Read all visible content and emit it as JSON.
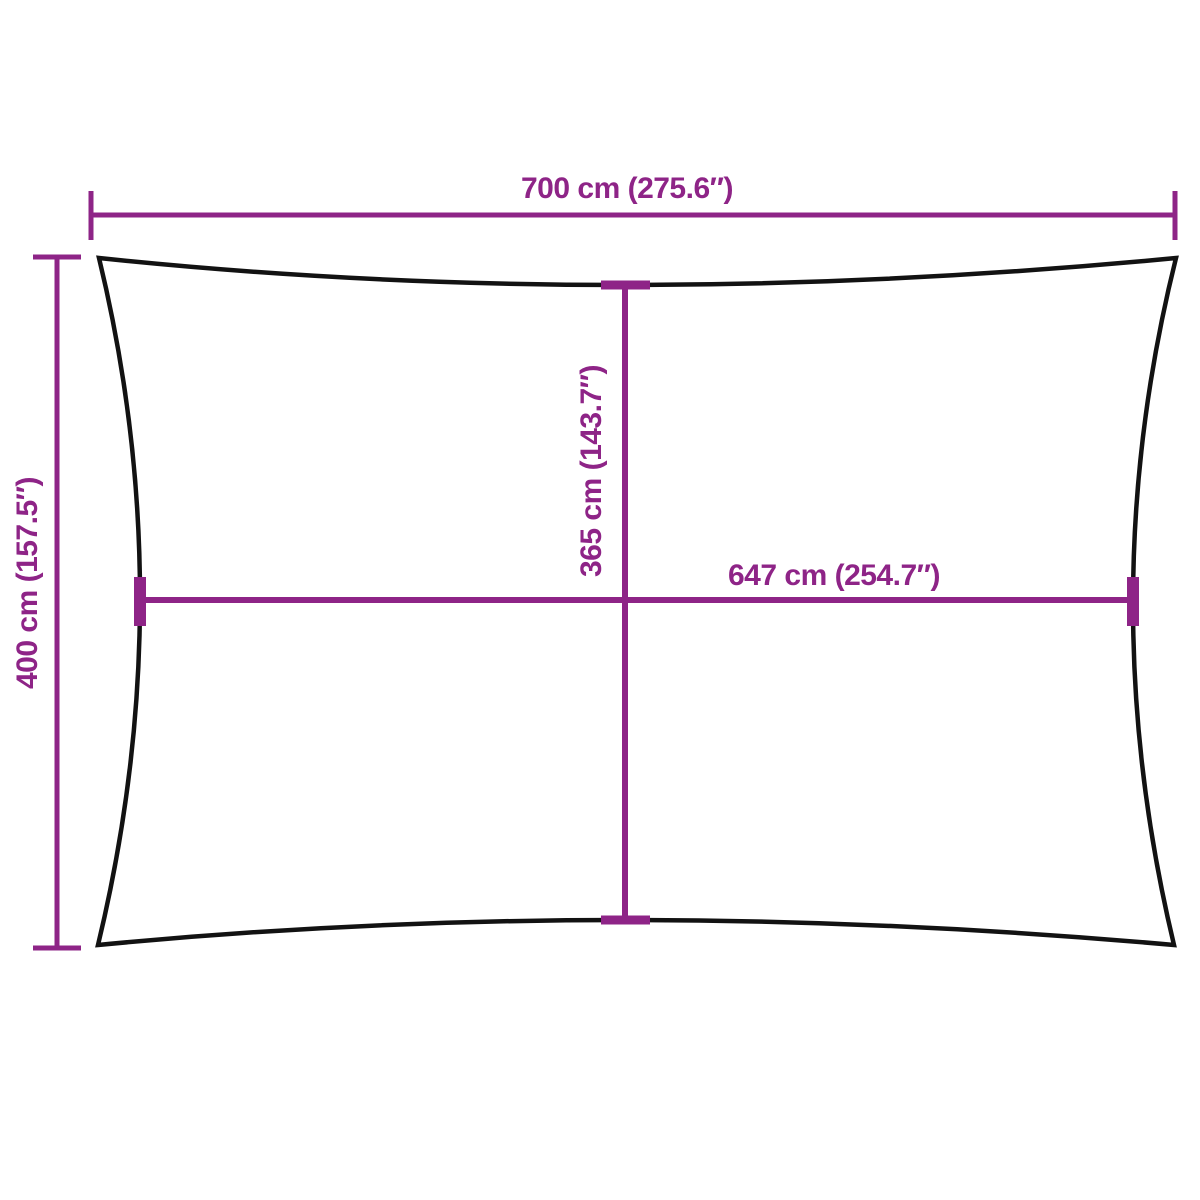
{
  "colors": {
    "dimension": "#8E2487",
    "outline": "#121212",
    "background": "#ffffff"
  },
  "sail": {
    "shape_name": "rectangular-shade-sail-concave-edges"
  },
  "dimensions": {
    "top_width": {
      "label": "700 cm (275.6″)",
      "value_cm": 700,
      "value_inches": 275.6
    },
    "left_height": {
      "label": "400 cm (157.5″)",
      "value_cm": 400,
      "value_inches": 157.5
    },
    "center_height": {
      "label": "365 cm (143.7″)",
      "value_cm": 365,
      "value_inches": 143.7
    },
    "center_width": {
      "label": "647 cm (254.7″)",
      "value_cm": 647,
      "value_inches": 254.7
    }
  }
}
